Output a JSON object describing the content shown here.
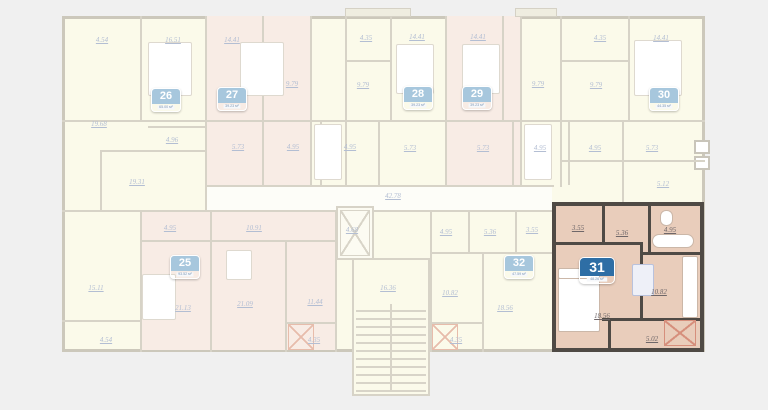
{
  "page": {
    "background": "#f0f0f0"
  },
  "plan": {
    "selected_apartment": "31",
    "colors": {
      "highlight_fill": "#e9cdbb",
      "highlight_wall": "#4f4a45",
      "faded_fill_yellow": "#fbfaea",
      "faded_fill_pink": "#f8ece5",
      "faded_wall": "#d7d3c7",
      "faded_label": "#b3bed3",
      "badge_blue_active": "#2e6ea5",
      "badge_blue_faded": "#a7c7dd",
      "balcony_hatch_red": "#d68f7c"
    }
  },
  "core": {
    "corridor_area": "42.78",
    "stairwell_area": "16.36",
    "elevator_area": "4.68"
  },
  "units": {
    "u25": {
      "number": "25",
      "area_label": "93.52 м²",
      "areas": [
        "4.95",
        "10.91",
        "15.11",
        "21.13",
        "21.09",
        "11.44",
        "4.54",
        "4.35"
      ]
    },
    "u26": {
      "number": "26",
      "area_label": "65.00 м²",
      "areas": [
        "4.54",
        "16.51",
        "19.68",
        "4.96",
        "19.31"
      ]
    },
    "u27": {
      "number": "27",
      "area_label": "39.23 м²",
      "areas": [
        "14.41",
        "9.79",
        "5.73",
        "4.95"
      ]
    },
    "u28": {
      "number": "28",
      "area_label": "39.23 м²",
      "areas": [
        "4.35",
        "14.41",
        "9.79",
        "4.95",
        "5.73"
      ]
    },
    "u29": {
      "number": "29",
      "area_label": "39.23 м²",
      "areas": [
        "14.41",
        "9.79",
        "5.73",
        "4.95"
      ]
    },
    "u30": {
      "number": "30",
      "area_label": "44.35 м²",
      "areas": [
        "4.35",
        "14.41",
        "9.79",
        "4.95",
        "5.73",
        "5.12"
      ]
    },
    "u31": {
      "number": "31",
      "area_label": "48.26 м²",
      "areas": [
        "3.55",
        "5.36",
        "4.95",
        "18.56",
        "10.82",
        "5.02"
      ]
    },
    "u32": {
      "number": "32",
      "area_label": "47.59 м²",
      "areas": [
        "4.95",
        "5.36",
        "3.55",
        "10.82",
        "18.56",
        "4.35"
      ]
    }
  }
}
